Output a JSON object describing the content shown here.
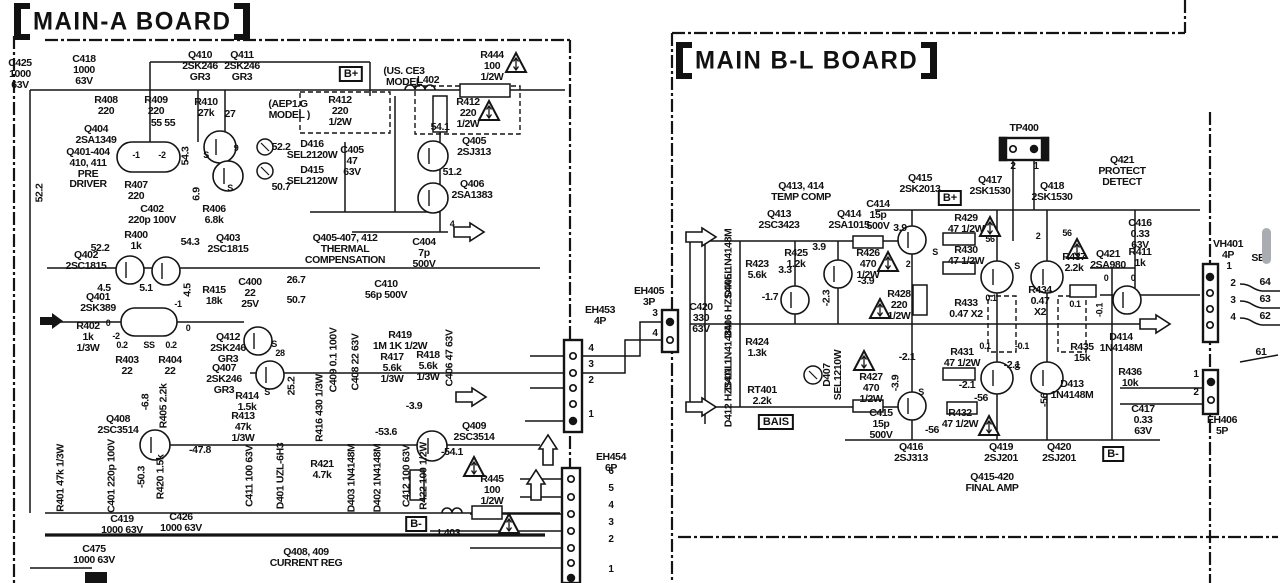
{
  "boards": [
    {
      "name": "main-a",
      "title": "MAIN-A BOARD"
    },
    {
      "name": "main-b-l",
      "title": "MAIN B-L BOARD"
    }
  ],
  "accent_ink": "#141414",
  "badges": [
    {
      "t": "B+",
      "x": 351,
      "y": 66
    },
    {
      "t": "B+",
      "x": 950,
      "y": 190
    },
    {
      "t": "B-",
      "x": 416,
      "y": 516
    },
    {
      "t": "B-",
      "x": 1113,
      "y": 446
    },
    {
      "t": "BAIS",
      "x": 776,
      "y": 414
    }
  ],
  "labels": [
    {
      "t": "C425\n1000\n63V",
      "x": 20,
      "y": 58
    },
    {
      "t": "C418\n1000\n63V",
      "x": 84,
      "y": 54
    },
    {
      "t": "Q410\n2SK246\nGR3",
      "x": 200,
      "y": 50
    },
    {
      "t": "Q411\n2SK246\nGR3",
      "x": 242,
      "y": 50
    },
    {
      "t": "R408\n220",
      "x": 106,
      "y": 95
    },
    {
      "t": "R409\n220",
      "x": 156,
      "y": 95
    },
    {
      "t": "R410\n27k",
      "x": 206,
      "y": 97
    },
    {
      "t": "27",
      "x": 230,
      "y": 109
    },
    {
      "t": "(US. CE3\nMODEL",
      "x": 404,
      "y": 66
    },
    {
      "t": "L402",
      "x": 428,
      "y": 75
    },
    {
      "t": "R444\n100\n1/2W",
      "x": 492,
      "y": 50
    },
    {
      "t": "(AEP1.G\n MODEL )",
      "x": 288,
      "y": 99
    },
    {
      "t": "R412\n220\n1/2W",
      "x": 340,
      "y": 95
    },
    {
      "t": "R412\n220\n1/2W",
      "x": 468,
      "y": 97
    },
    {
      "t": "54.1",
      "x": 440,
      "y": 122
    },
    {
      "t": "Q404\n2SA1349",
      "x": 96,
      "y": 124
    },
    {
      "t": "55 55",
      "x": 163,
      "y": 118
    },
    {
      "t": "Q401-404\n410, 411\nPRE\nDRIVER",
      "x": 88,
      "y": 147
    },
    {
      "t": "-1",
      "x": 136,
      "y": 151,
      "s": 9
    },
    {
      "t": "-2",
      "x": 162,
      "y": 151,
      "s": 9
    },
    {
      "t": "S",
      "x": 206,
      "y": 151,
      "s": 9
    },
    {
      "t": "9",
      "x": 236,
      "y": 144,
      "s": 9
    },
    {
      "t": "S",
      "x": 230,
      "y": 184,
      "s": 9
    },
    {
      "t": "D416\nSEL2120W",
      "x": 312,
      "y": 139
    },
    {
      "t": "D415\nSEL2120W",
      "x": 312,
      "y": 165
    },
    {
      "t": "C405\n47\n63V",
      "x": 352,
      "y": 145
    },
    {
      "t": "52.2",
      "x": 281,
      "y": 142
    },
    {
      "t": "Q405\n2SJ313",
      "x": 474,
      "y": 136
    },
    {
      "t": "51.2",
      "x": 452,
      "y": 167
    },
    {
      "t": "Q406\n2SA1383",
      "x": 472,
      "y": 179
    },
    {
      "t": "50.7",
      "x": 281,
      "y": 182
    },
    {
      "t": "52.2",
      "x": 40,
      "y": 193,
      "r": 1
    },
    {
      "t": "R407\n220",
      "x": 136,
      "y": 180
    },
    {
      "t": "C402\n220p 100V",
      "x": 152,
      "y": 204
    },
    {
      "t": "54.3",
      "x": 186,
      "y": 156,
      "r": 1
    },
    {
      "t": "6.9",
      "x": 197,
      "y": 194,
      "r": 1
    },
    {
      "t": "R406\n6.8k",
      "x": 214,
      "y": 204
    },
    {
      "t": "R400\n1k",
      "x": 136,
      "y": 230
    },
    {
      "t": "52.2",
      "x": 100,
      "y": 243
    },
    {
      "t": "54.3",
      "x": 190,
      "y": 237
    },
    {
      "t": "Q403\n2SC1815",
      "x": 228,
      "y": 233
    },
    {
      "t": "Q402\n2SC1815",
      "x": 86,
      "y": 250
    },
    {
      "t": "4.5",
      "x": 104,
      "y": 283
    },
    {
      "t": "5.1",
      "x": 146,
      "y": 283
    },
    {
      "t": "4.5",
      "x": 188,
      "y": 290,
      "r": 1
    },
    {
      "t": "R415\n18k",
      "x": 214,
      "y": 285
    },
    {
      "t": "C400\n22\n25V",
      "x": 250,
      "y": 277
    },
    {
      "t": "26.7",
      "x": 296,
      "y": 275
    },
    {
      "t": "50.7",
      "x": 296,
      "y": 295
    },
    {
      "t": "Q401\n2SK389",
      "x": 98,
      "y": 292
    },
    {
      "t": "-1",
      "x": 178,
      "y": 300,
      "s": 9
    },
    {
      "t": "R402\n1k\n1/3W",
      "x": 88,
      "y": 321
    },
    {
      "t": "0",
      "x": 108,
      "y": 319,
      "s": 9
    },
    {
      "t": "-2",
      "x": 116,
      "y": 332,
      "s": 9
    },
    {
      "t": "0.2",
      "x": 122,
      "y": 341,
      "s": 9
    },
    {
      "t": "SS",
      "x": 149,
      "y": 341,
      "s": 9
    },
    {
      "t": "0.2",
      "x": 171,
      "y": 341,
      "s": 9
    },
    {
      "t": "0",
      "x": 188,
      "y": 324,
      "s": 9
    },
    {
      "t": "R403\n22",
      "x": 127,
      "y": 355
    },
    {
      "t": "R404\n22",
      "x": 170,
      "y": 355
    },
    {
      "t": "Q412\n2SK246\nGR3",
      "x": 228,
      "y": 332
    },
    {
      "t": "S",
      "x": 274,
      "y": 340,
      "s": 9
    },
    {
      "t": "28",
      "x": 280,
      "y": 349,
      "s": 9
    },
    {
      "t": "Q407\n2SK246\nGR3",
      "x": 224,
      "y": 363
    },
    {
      "t": "S",
      "x": 267,
      "y": 388,
      "s": 9
    },
    {
      "t": "C409 0.1 100V",
      "x": 334,
      "y": 360,
      "r": 1
    },
    {
      "t": "C408 22 63V",
      "x": 356,
      "y": 362,
      "r": 1
    },
    {
      "t": "R419\n1M 1K 1/2W",
      "x": 400,
      "y": 330
    },
    {
      "t": "R417\n5.6k\n1/3W",
      "x": 392,
      "y": 352
    },
    {
      "t": "R418\n5.6k\n1/3W",
      "x": 428,
      "y": 350
    },
    {
      "t": "C410\n56p 500V",
      "x": 386,
      "y": 279
    },
    {
      "t": "Q405-407, 412\nTHERMAL\nCOMPENSATION",
      "x": 345,
      "y": 233
    },
    {
      "t": "C404\n7p\n500V",
      "x": 424,
      "y": 237
    },
    {
      "t": "4",
      "x": 452,
      "y": 220,
      "s": 9
    },
    {
      "t": "C406 47 63V",
      "x": 450,
      "y": 358,
      "r": 1
    },
    {
      "t": "R414\n1.5k",
      "x": 247,
      "y": 391
    },
    {
      "t": "R413\n47k\n1/3W",
      "x": 243,
      "y": 411
    },
    {
      "t": "25.2",
      "x": 292,
      "y": 386,
      "r": 1
    },
    {
      "t": "R416 430 1/3W",
      "x": 320,
      "y": 408,
      "r": 1
    },
    {
      "t": "-3.9",
      "x": 414,
      "y": 401
    },
    {
      "t": "-53.6",
      "x": 386,
      "y": 427
    },
    {
      "t": "Q409\n2SC3514",
      "x": 474,
      "y": 421
    },
    {
      "t": "-54.1",
      "x": 452,
      "y": 447
    },
    {
      "t": "Q408\n2SC3514",
      "x": 118,
      "y": 414
    },
    {
      "t": "-6.8",
      "x": 146,
      "y": 402,
      "r": 1
    },
    {
      "t": "R405 2.2k",
      "x": 164,
      "y": 406,
      "r": 1
    },
    {
      "t": "-47.8",
      "x": 200,
      "y": 445
    },
    {
      "t": "R401 47k 1/3W",
      "x": 61,
      "y": 478,
      "r": 1
    },
    {
      "t": "C401 220p 100V",
      "x": 112,
      "y": 476,
      "r": 1
    },
    {
      "t": "-50.3",
      "x": 142,
      "y": 477,
      "r": 1
    },
    {
      "t": "R420 1.5k",
      "x": 161,
      "y": 477,
      "r": 1
    },
    {
      "t": "C411 100 63V",
      "x": 250,
      "y": 476,
      "r": 1
    },
    {
      "t": "D401 UZL-6H3",
      "x": 281,
      "y": 476,
      "r": 1
    },
    {
      "t": "R421\n4.7k",
      "x": 322,
      "y": 459
    },
    {
      "t": "D403 1N4148M",
      "x": 352,
      "y": 478,
      "r": 1
    },
    {
      "t": "D402 1N4148M",
      "x": 378,
      "y": 478,
      "r": 1
    },
    {
      "t": "C412 100 63V",
      "x": 407,
      "y": 476,
      "r": 1
    },
    {
      "t": "R422 100 1/2W",
      "x": 424,
      "y": 476,
      "r": 1
    },
    {
      "t": "R445\n100\n1/2W",
      "x": 492,
      "y": 474
    },
    {
      "t": "L403",
      "x": 449,
      "y": 528
    },
    {
      "t": "C419\n1000 63V",
      "x": 122,
      "y": 514
    },
    {
      "t": "C426\n1000 63V",
      "x": 181,
      "y": 512
    },
    {
      "t": "C475\n1000 63V",
      "x": 94,
      "y": 544
    },
    {
      "t": "Q408, 409\nCURRENT REG",
      "x": 306,
      "y": 547
    },
    {
      "t": "EH453\n4P",
      "x": 600,
      "y": 305
    },
    {
      "t": "4",
      "x": 591,
      "y": 344,
      "s": 10
    },
    {
      "t": "3",
      "x": 591,
      "y": 360,
      "s": 10
    },
    {
      "t": "2",
      "x": 591,
      "y": 376,
      "s": 10
    },
    {
      "t": "1",
      "x": 591,
      "y": 410,
      "s": 10
    },
    {
      "t": "EH405\n3P",
      "x": 649,
      "y": 286
    },
    {
      "t": "3",
      "x": 655,
      "y": 309,
      "s": 10
    },
    {
      "t": "4",
      "x": 655,
      "y": 329,
      "s": 10
    },
    {
      "t": "C420\n330\n63V",
      "x": 701,
      "y": 302
    },
    {
      "t": "EH454\n6P",
      "x": 611,
      "y": 452
    },
    {
      "t": "6",
      "x": 611,
      "y": 467,
      "s": 10
    },
    {
      "t": "5",
      "x": 611,
      "y": 484,
      "s": 10
    },
    {
      "t": "4",
      "x": 611,
      "y": 501,
      "s": 10
    },
    {
      "t": "3",
      "x": 611,
      "y": 518,
      "s": 10
    },
    {
      "t": "2",
      "x": 611,
      "y": 535,
      "s": 10
    },
    {
      "t": "1",
      "x": 611,
      "y": 565,
      "s": 10
    },
    {
      "t": "TP400",
      "x": 1024,
      "y": 123
    },
    {
      "t": "2",
      "x": 1013,
      "y": 162,
      "s": 10
    },
    {
      "t": "1",
      "x": 1036,
      "y": 162,
      "s": 10
    },
    {
      "t": "Q421\nPROTECT\nDETECT",
      "x": 1122,
      "y": 155
    },
    {
      "t": "Q413, 414\nTEMP COMP",
      "x": 801,
      "y": 181
    },
    {
      "t": "Q413\n2SC3423",
      "x": 779,
      "y": 209
    },
    {
      "t": "Q414\n2SA1015",
      "x": 849,
      "y": 209
    },
    {
      "t": "C414\n15p\n500V",
      "x": 878,
      "y": 199
    },
    {
      "t": "3.9",
      "x": 900,
      "y": 223
    },
    {
      "t": "Q415\n2SK2013",
      "x": 920,
      "y": 173
    },
    {
      "t": "Q417\n2SK1530",
      "x": 990,
      "y": 175
    },
    {
      "t": "Q418\n2SK1530",
      "x": 1052,
      "y": 181
    },
    {
      "t": "R429\n47 1/2W",
      "x": 966,
      "y": 213
    },
    {
      "t": "R430\n47 1/2W",
      "x": 966,
      "y": 245
    },
    {
      "t": "56",
      "x": 990,
      "y": 235,
      "s": 9
    },
    {
      "t": "2",
      "x": 1038,
      "y": 232,
      "s": 9
    },
    {
      "t": "56",
      "x": 1067,
      "y": 229,
      "s": 9
    },
    {
      "t": "2",
      "x": 908,
      "y": 260,
      "s": 9
    },
    {
      "t": "R437\n2.2k",
      "x": 1074,
      "y": 252
    },
    {
      "t": "Q421\n2SA980",
      "x": 1108,
      "y": 249
    },
    {
      "t": "R411\n1k",
      "x": 1140,
      "y": 247
    },
    {
      "t": "C416\n0.33\n63V",
      "x": 1140,
      "y": 218
    },
    {
      "t": "0",
      "x": 1106,
      "y": 274,
      "s": 9
    },
    {
      "t": "0",
      "x": 1133,
      "y": 274,
      "s": 9
    },
    {
      "t": "R433\n0.47 X2",
      "x": 966,
      "y": 298
    },
    {
      "t": "R434\n0.47\nX2",
      "x": 1040,
      "y": 285
    },
    {
      "t": "0.1",
      "x": 991,
      "y": 294,
      "s": 9
    },
    {
      "t": "0.1",
      "x": 1075,
      "y": 300,
      "s": 9
    },
    {
      "t": "-0.1",
      "x": 1100,
      "y": 310,
      "r": 1,
      "s": 9
    },
    {
      "t": "0.1",
      "x": 985,
      "y": 342,
      "s": 9
    },
    {
      "t": "-0.1",
      "x": 1022,
      "y": 342,
      "s": 9
    },
    {
      "t": "R431\n47 1/2W",
      "x": 962,
      "y": 347
    },
    {
      "t": "-2.1",
      "x": 1012,
      "y": 360
    },
    {
      "t": "-2.1",
      "x": 967,
      "y": 380
    },
    {
      "t": "-56",
      "x": 981,
      "y": 393
    },
    {
      "t": "-56",
      "x": 1045,
      "y": 400,
      "r": 1
    },
    {
      "t": "R435\n15k",
      "x": 1082,
      "y": 342
    },
    {
      "t": "D414\n1N4148M",
      "x": 1121,
      "y": 332
    },
    {
      "t": "R436\n10k",
      "x": 1130,
      "y": 367
    },
    {
      "t": "D413\n1N4148M",
      "x": 1072,
      "y": 379
    },
    {
      "t": "R432\n47 1/2W",
      "x": 960,
      "y": 408
    },
    {
      "t": "-56",
      "x": 932,
      "y": 425
    },
    {
      "t": "C415\n15p\n500V",
      "x": 881,
      "y": 408
    },
    {
      "t": "Q416\n2SJ313",
      "x": 911,
      "y": 442
    },
    {
      "t": "Q419\n2SJ201",
      "x": 1001,
      "y": 442
    },
    {
      "t": "Q420\n2SJ201",
      "x": 1059,
      "y": 442
    },
    {
      "t": "Q415-420\nFINAL AMP",
      "x": 992,
      "y": 472
    },
    {
      "t": "C417\n0.33\n63V",
      "x": 1143,
      "y": 404
    },
    {
      "t": "D405 1N4148M",
      "x": 729,
      "y": 263,
      "r": 1
    },
    {
      "t": "D406 HZS4ALL",
      "x": 729,
      "y": 303,
      "r": 1
    },
    {
      "t": "D411 1N4148M",
      "x": 729,
      "y": 356,
      "r": 1
    },
    {
      "t": "D412 HZS4ALL",
      "x": 729,
      "y": 392,
      "r": 1
    },
    {
      "t": "R423\n5.6k",
      "x": 757,
      "y": 259
    },
    {
      "t": "3.3",
      "x": 785,
      "y": 265
    },
    {
      "t": "R425\n1.2k",
      "x": 796,
      "y": 248
    },
    {
      "t": "3.9",
      "x": 819,
      "y": 242
    },
    {
      "t": "-1.7",
      "x": 770,
      "y": 292
    },
    {
      "t": "-2.3",
      "x": 827,
      "y": 298,
      "r": 1
    },
    {
      "t": "-3.9",
      "x": 866,
      "y": 276
    },
    {
      "t": "R426\n470\n1/2W",
      "x": 868,
      "y": 248
    },
    {
      "t": "R428\n220\n1/2W",
      "x": 899,
      "y": 289
    },
    {
      "t": "R424\n1.3k",
      "x": 757,
      "y": 337
    },
    {
      "t": "D407\nSEL1210W",
      "x": 833,
      "y": 375,
      "r": 1
    },
    {
      "t": "RT401\n2.2k",
      "x": 762,
      "y": 385
    },
    {
      "t": "R427\n470\n1/2W",
      "x": 871,
      "y": 372
    },
    {
      "t": "-2.1",
      "x": 907,
      "y": 352
    },
    {
      "t": "-3.9",
      "x": 896,
      "y": 383,
      "r": 1
    },
    {
      "t": "S",
      "x": 935,
      "y": 248,
      "s": 9
    },
    {
      "t": "S",
      "x": 1017,
      "y": 262,
      "s": 9
    },
    {
      "t": "S",
      "x": 921,
      "y": 388,
      "s": 9
    },
    {
      "t": "S",
      "x": 1017,
      "y": 363,
      "s": 9
    },
    {
      "t": "VH401\n4P",
      "x": 1228,
      "y": 239
    },
    {
      "t": "1",
      "x": 1229,
      "y": 262,
      "s": 10
    },
    {
      "t": "2",
      "x": 1233,
      "y": 279,
      "s": 10
    },
    {
      "t": "3",
      "x": 1233,
      "y": 296,
      "s": 10
    },
    {
      "t": "4",
      "x": 1233,
      "y": 313,
      "s": 10
    },
    {
      "t": "SE",
      "x": 1258,
      "y": 253
    },
    {
      "t": "64",
      "x": 1265,
      "y": 277
    },
    {
      "t": "63",
      "x": 1265,
      "y": 294
    },
    {
      "t": "62",
      "x": 1265,
      "y": 311
    },
    {
      "t": "61",
      "x": 1261,
      "y": 347
    },
    {
      "t": "1",
      "x": 1196,
      "y": 370,
      "s": 10
    },
    {
      "t": "2",
      "x": 1196,
      "y": 388,
      "s": 10
    },
    {
      "t": "EH406\n5P",
      "x": 1222,
      "y": 415
    }
  ]
}
